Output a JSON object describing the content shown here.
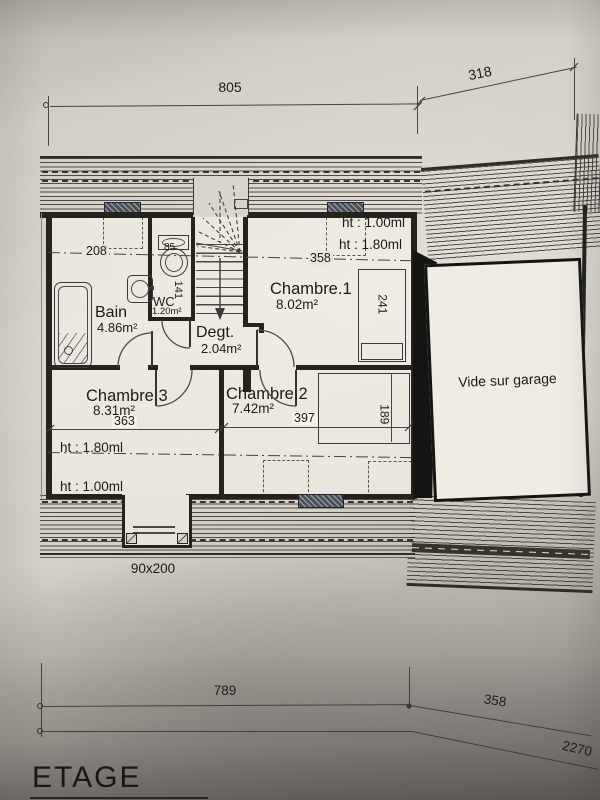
{
  "meta": {
    "floor_title": "ETAGE"
  },
  "rooms": {
    "bain": {
      "name": "Bain",
      "area": "4.86m²"
    },
    "wc": {
      "name": "WC",
      "area": "1.20m²"
    },
    "degt": {
      "name": "Degt.",
      "area": "2.04m²"
    },
    "chambre1": {
      "name": "Chambre.1",
      "area": "8.02m²"
    },
    "chambre2": {
      "name": "Chambre.2",
      "area": "7.42m²"
    },
    "chambre3": {
      "name": "Chambre.3",
      "area": "8.31m²"
    },
    "vide": {
      "name": "Vide sur garage"
    }
  },
  "dims": {
    "top_width": "805",
    "top_right_width": "318",
    "bain_width": "208",
    "wc_width": "85",
    "wc_depth": "141",
    "ch1_width": "358",
    "ch1_closet": "241",
    "ch3_width": "363",
    "ch2_width": "397",
    "ch2_closet": "189",
    "bottom_left": "789",
    "bottom_right": "358",
    "bottom_total": "2270",
    "door": "90x200"
  },
  "heights": {
    "top_h100": "ht : 1.00ml",
    "top_h180": "ht : 1.80ml",
    "bottom_h180": "ht : 1.80ml",
    "bottom_h100": "ht : 1.00ml"
  },
  "colors": {
    "paper": "#d9d5cc",
    "interior": "#eae6db",
    "ink": "#2a2a2a",
    "velux": "#454a55"
  }
}
